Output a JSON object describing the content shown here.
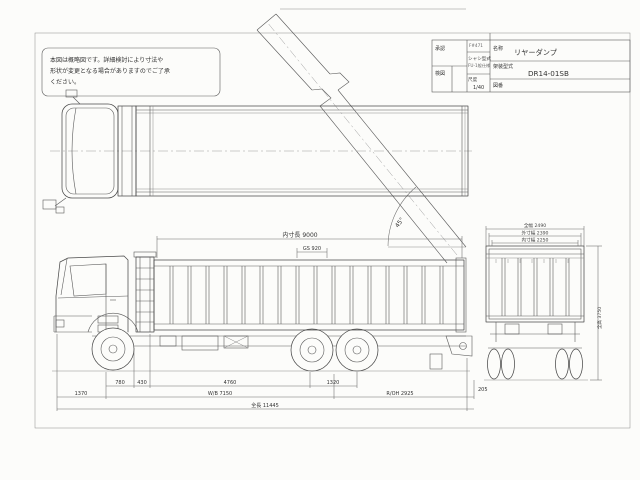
{
  "note": {
    "lines": [
      "本図は概略図です。詳細検討により寸法や",
      "形状が変更となる場合がありますのでご了承",
      "ください。"
    ]
  },
  "title_block": {
    "approval_label": "承認",
    "check_label": "検図",
    "code": "F#471",
    "chassis_label": "シャシ型式",
    "chassis_value": "FU-1般仕様",
    "scale_label": "尺度",
    "scale_value": "1/40",
    "name_label": "名称",
    "name_value": "リヤーダンプ",
    "body_model_label": "架装型式",
    "body_model_value": "DR14-01SB",
    "drawing_no_label": "図番",
    "drawing_no_value": ""
  },
  "dimensions": {
    "plan": {
      "tip_angle": "45°"
    },
    "side_top": {
      "inner_length": "内寸長 9000",
      "front_section": "GS 920"
    },
    "side_bottom": {
      "row1": [
        "780",
        "430",
        "4760",
        "1320"
      ],
      "row2": [
        "1370",
        "W/B 7150",
        "R/OH 2925",
        "205"
      ],
      "total": "全長 11445"
    },
    "rear": {
      "overall_width": "全幅 2490",
      "outer_width": "外寸幅 2390",
      "inner_width": "内寸幅 2250",
      "overall_height": "全高 3750"
    }
  }
}
